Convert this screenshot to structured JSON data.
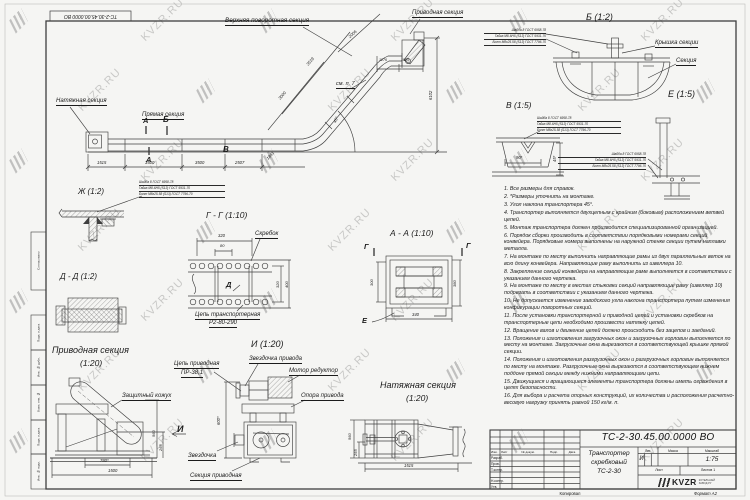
{
  "watermark": {
    "text": "KVZR.RU"
  },
  "stamp_top_left": "ТС-2-30.45.00.0000  ВО",
  "fastener": [
    "Шайба 8 ГОСТ 6958-78",
    "Гайка М8-6Н5 (S13) ГОСТ 5931-70",
    "Болт М8х25.58 (S13) ГОСТ 7796-70"
  ],
  "main_view": {
    "labels": {
      "upper_turn": "Верхняя поворотная секция",
      "drive": "Приводная секция",
      "tension": "Натяжная секция",
      "straight": "Прямая секция",
      "see_note": "см. п. 7",
      "mark_a_top": "А",
      "mark_a_bottom": "А",
      "mark_b": "Б",
      "mark_v": "В"
    },
    "dims": {
      "b1": "1515",
      "b2": "3500",
      "b3": "3500",
      "b4": "2507",
      "incline_base": "1841",
      "incline_1": "3000",
      "incline_2": "3519",
      "incline_top": "2006",
      "top_1": "1276",
      "top_2": "1505",
      "height": "6102",
      "angle": "45°"
    }
  },
  "views": {
    "b": {
      "title": "Б (1:2)",
      "label_cover": "Крышка секции",
      "label_section": "Секция"
    },
    "v": {
      "title": "В (1:5)",
      "dim_w": "90*",
      "dim_h": "45*"
    },
    "e": {
      "title": "Е (1:5)"
    },
    "zh": {
      "title": "Ж (1:2)"
    },
    "dd": {
      "title": "Д - Д (1:2)"
    },
    "gg": {
      "title": "Г - Г (1:10)",
      "label_scraper": "Скребок",
      "label_chain_1": "Цепь транспортерная",
      "label_chain_2": "Р2-80-290",
      "marker_d": "Д",
      "dim_top": "320",
      "dim_top2": "80",
      "dim_right": "320",
      "dim_right2": "400"
    },
    "aa": {
      "title": "А - А (1:10)",
      "marker_g_left": "Г",
      "marker_g_right": "Г",
      "marker_e": "Е",
      "dim_left": "300",
      "dim_right": "380",
      "dim_bottom": "340"
    },
    "drive_section": {
      "title_1": "Приводная секция",
      "title_2": "(1:20)",
      "label_guard": "Защитный кожух",
      "marker_i": "И",
      "dim_w1": "780*",
      "dim_w2": "1500",
      "dim_h1": "560",
      "dim_h2": "265"
    },
    "i": {
      "title": "И (1:20)",
      "label_chain_1": "Цепь приводная",
      "label_chain_2": "ПР-38,1",
      "label_drive_sprocket": "Звездочка привода",
      "label_motor": "Мотор редуктор",
      "label_support": "Опора привода",
      "label_sprocket": "Звездочка",
      "label_section": "Секция приводная",
      "dim_h": "600*"
    },
    "tension_section": {
      "title_1": "Натяжная секция",
      "title_2": "(1:20)",
      "dim_h1": "560",
      "dim_h2": "255",
      "dim_w": "1515"
    }
  },
  "notes": [
    "1. Все размеры для справок.",
    "2. *Размеры уточнить на монтаже.",
    "3. Угол наклона транспортера 45°.",
    "4. Транспортер выполняется двухцепным с крайним (боковым) расположением ветвей цепей.",
    "5. Монтаж транспортера должен производится специализированной организацией.",
    "6. Порядок сборки производить в соответствии порядковыми номерами секций конвейера. Порядковые номера выполнены на наружной стенке секции путем наплавки металла.",
    "7. На монтаже по месту выполнить направляющие рамы из двух параллельных веток на всю длину конвейера. Направляющие раму выполнить из швеллера 10.",
    "8. Закрепление секций конвейера на направляющие раме выполняется в соответствии с указанием данного чертежа.",
    "9. На монтаже по месту в местах стыковки секций направляющие раму (швеллер 10) подрезать в соответствии с указанием данного чертежа.",
    "10. Не допускается изменение заводского угла наклона транспортера путем изменения конфигурации поворотных секций.",
    "11. После установки транспортерной и приводной цепей и установки скребков на транспортерные цепи необходимо произвести натяжку цепей.",
    "12. Вращение валов и движение цепей должно происходить без зацепов и заеданий.",
    "13. Положения и изготовления загрузочных окон и загрузочных горловин выполняется по месту на монтаже. Загрузочные окна вырезаются в соответствующей крышке прямой секции.",
    "14. Положения и изготовления разгрузочных окон и разгрузочных горловин выполняется по месту на монтаже. Разгрузочные окна вырезаются в соответствующем нижнем поддоне прямой секции между нижними направляющими цепи.",
    "15. Движущиеся и вращающиеся элементы транспортера должны иметь ограждения в целях безопасности.",
    "16. Для выбора и расчета опорных конструкций, их количества и расположения расчетно-весовую нагрузку принять равной 150 кг/м. п."
  ],
  "title_block": {
    "doc_number": "ТС-2-30.45.00.0000  ВО",
    "name_1": "Транспортер",
    "name_2": "скребковый",
    "name_3": "ТС-2-30",
    "col_izm": "Изм.",
    "col_list": "Лист",
    "col_doc": "№ докум.",
    "col_sign": "Подп.",
    "col_date": "Дата",
    "roles": [
      "Разраб.",
      "Пров.",
      "Т.контр.",
      "",
      "Н.контр.",
      "Утв."
    ],
    "lit_header": "Лит.",
    "mass_header": "Масса",
    "scale_header": "Масштаб",
    "lit_value": "И",
    "scale_value": "1:75",
    "sheet_label": "Лист",
    "sheets_label": "Листов 1",
    "logo_text": "KVZR",
    "logo_sub_1": "КОТЕЛЬНЫЙ",
    "logo_sub_2": "ЗАВОД.РУ",
    "copied": "Копировал",
    "format": "Формат А2"
  },
  "frame": {
    "left_labels": [
      "Согласовано",
      "Подп. и дата",
      "Инв. № дубл.",
      "Взам. инв. №",
      "Подп. и дата",
      "Инв. № подл."
    ]
  }
}
